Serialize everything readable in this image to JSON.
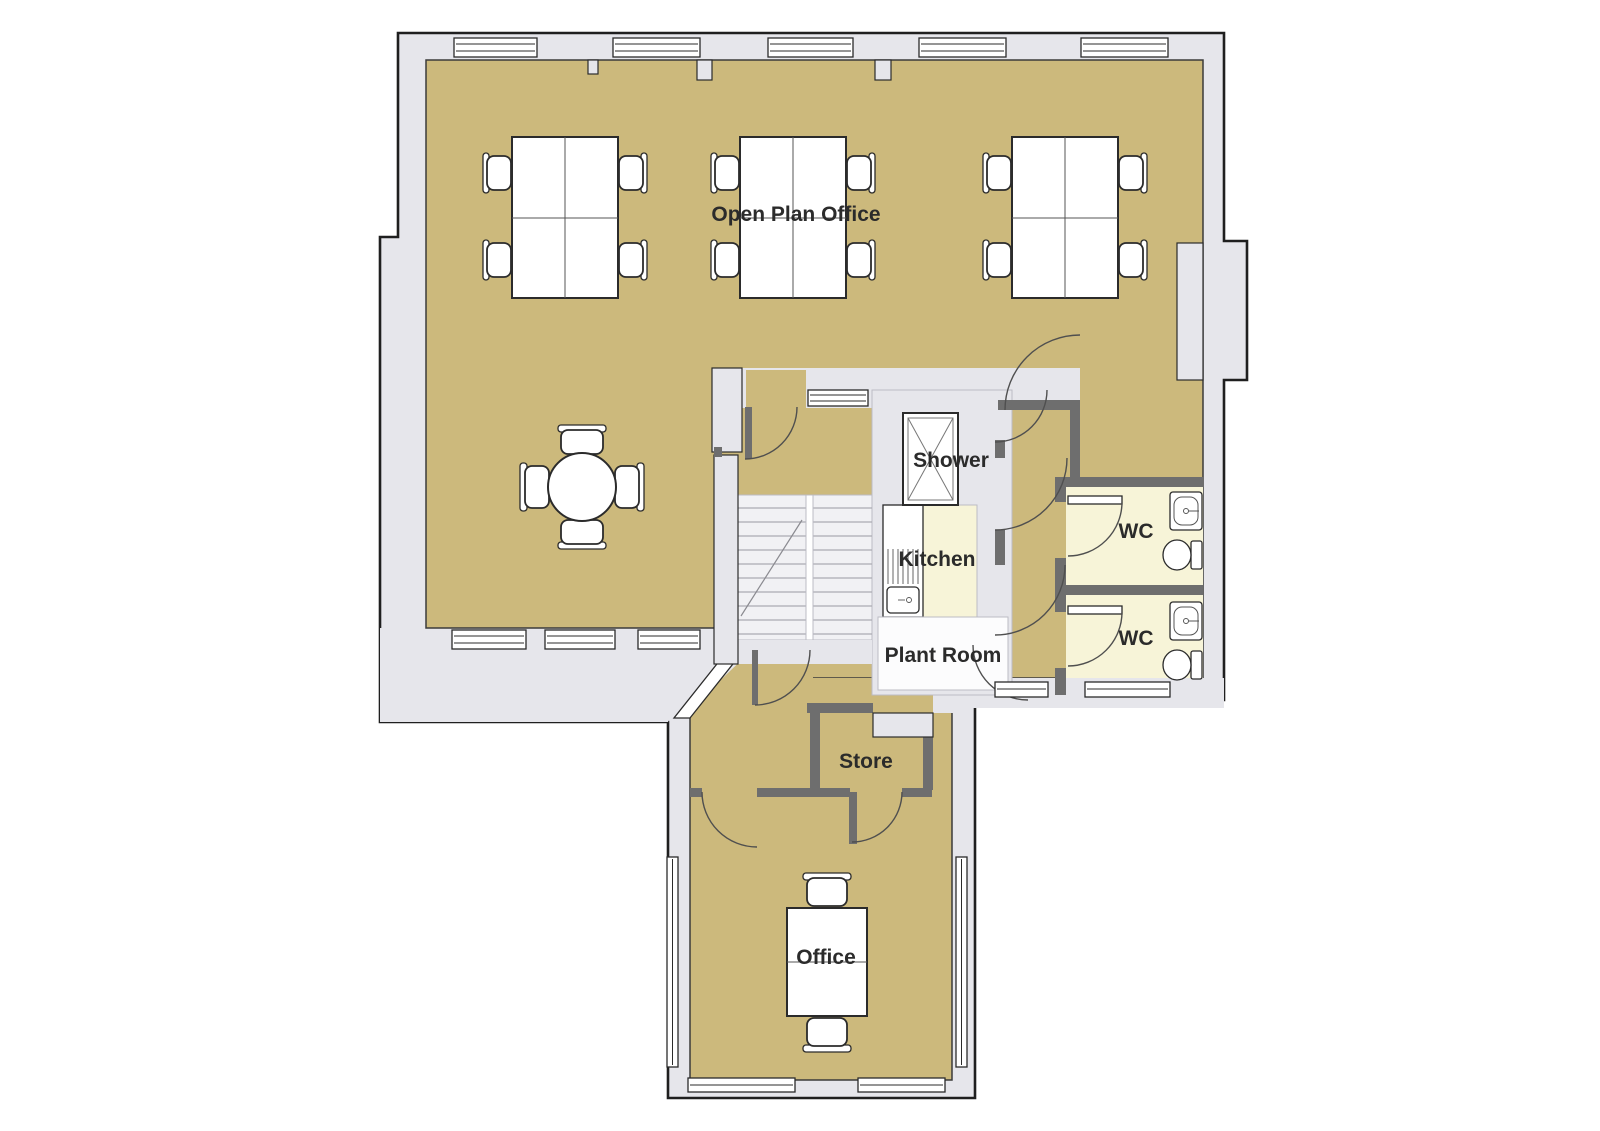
{
  "colors": {
    "floor": "#CCB97C",
    "wet_floor": "#F7F4D8",
    "wall_fill": "#E6E6EB",
    "wall_line": "#1F1F1F",
    "floor_line": "#3B3B3B",
    "partition": "#6E6E6E",
    "core_line": "#BCBCC4",
    "stair_floor": "#F1F1F4",
    "plant_floor": "#FCFCFD",
    "furniture": "#FFFFFF",
    "furniture_line": "#2B2B2B",
    "door_arc": "#4F4F4F",
    "label": "#2B2B2B",
    "tread_line": "#ABABB2",
    "background": "#FFFFFF"
  },
  "rooms": {
    "open_plan_office": {
      "label": "Open Plan Office"
    },
    "shower": {
      "label": "Shower"
    },
    "kitchen": {
      "label": "Kitchen"
    },
    "plant_room": {
      "label": "Plant Room"
    },
    "wc_top": {
      "label": "WC"
    },
    "wc_bottom": {
      "label": "WC"
    },
    "store": {
      "label": "Store"
    },
    "office": {
      "label": "Office"
    }
  }
}
